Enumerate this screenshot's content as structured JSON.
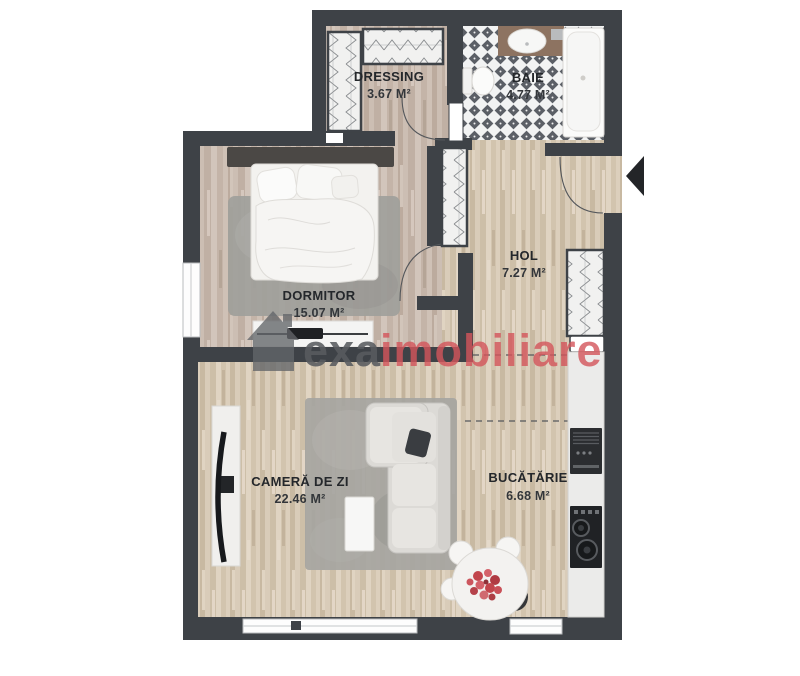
{
  "plan": {
    "background": "#ffffff",
    "colors": {
      "wall": "#3e4247",
      "label": "#24272b",
      "tile_dark": "#5b5f66",
      "wood_light": "#d7cab6",
      "wood_pink": "#c9bab0",
      "watermark_gray": "#595c60",
      "watermark_red": "#d4555b"
    },
    "rooms": {
      "dressing": {
        "name": "DRESSING",
        "area": "3.67 M²"
      },
      "baie": {
        "name": "BAIE",
        "area": "4.77 M²"
      },
      "dormitor": {
        "name": "DORMITOR",
        "area": "15.07 M²"
      },
      "hol": {
        "name": "HOL",
        "area": "7.27 M²"
      },
      "camera_de_zi": {
        "name": "CAMERĂ DE ZI",
        "area": "22.46 M²"
      },
      "bucatarie": {
        "name": "BUCĂTĂRIE",
        "area": "6.68 M²"
      }
    },
    "watermark": {
      "brand_gray": "exa",
      "brand_red": "imobiliare"
    }
  }
}
